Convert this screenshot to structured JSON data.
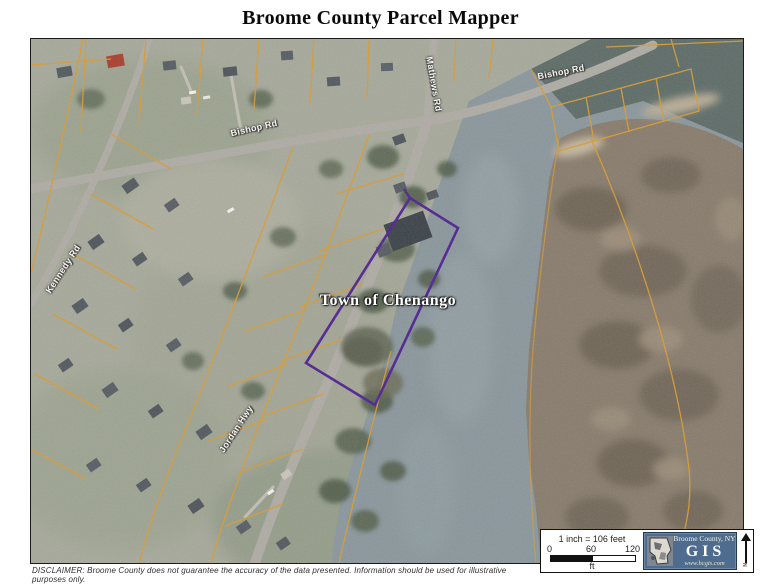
{
  "title": "Broome County Parcel Mapper",
  "map": {
    "town_label": "Town of Chenango",
    "road_labels": {
      "bishop_w": "Bishop Rd",
      "bishop_e": "Bishop Rd",
      "mathews": "Mathews Rd",
      "kennedy": "Kennedy Rd",
      "jordan": "Jordan Hwy"
    }
  },
  "scale_box": {
    "ratio": "1 inch = 106 feet",
    "tick0": "0",
    "tick1": "60",
    "tick2": "120",
    "unit": "ft"
  },
  "logo": {
    "region": "Broome County, NY",
    "acronym": "GIS",
    "url": "www.bcgis.com",
    "bg_color": "#4e6d8e"
  },
  "north_label": "N",
  "disclaimer": "DISCLAIMER:  Broome County does not guarantee the accuracy of the data presented.  Information should be used for illustrative purposes only.",
  "colors": {
    "parcel_line": "#d89b33",
    "selected_parcel": "#4f2391",
    "water": "#8a979c",
    "water_dark": "#5e6c68",
    "land": "#a6a99a",
    "island": "#887c6c",
    "road": "#aeaca4"
  }
}
